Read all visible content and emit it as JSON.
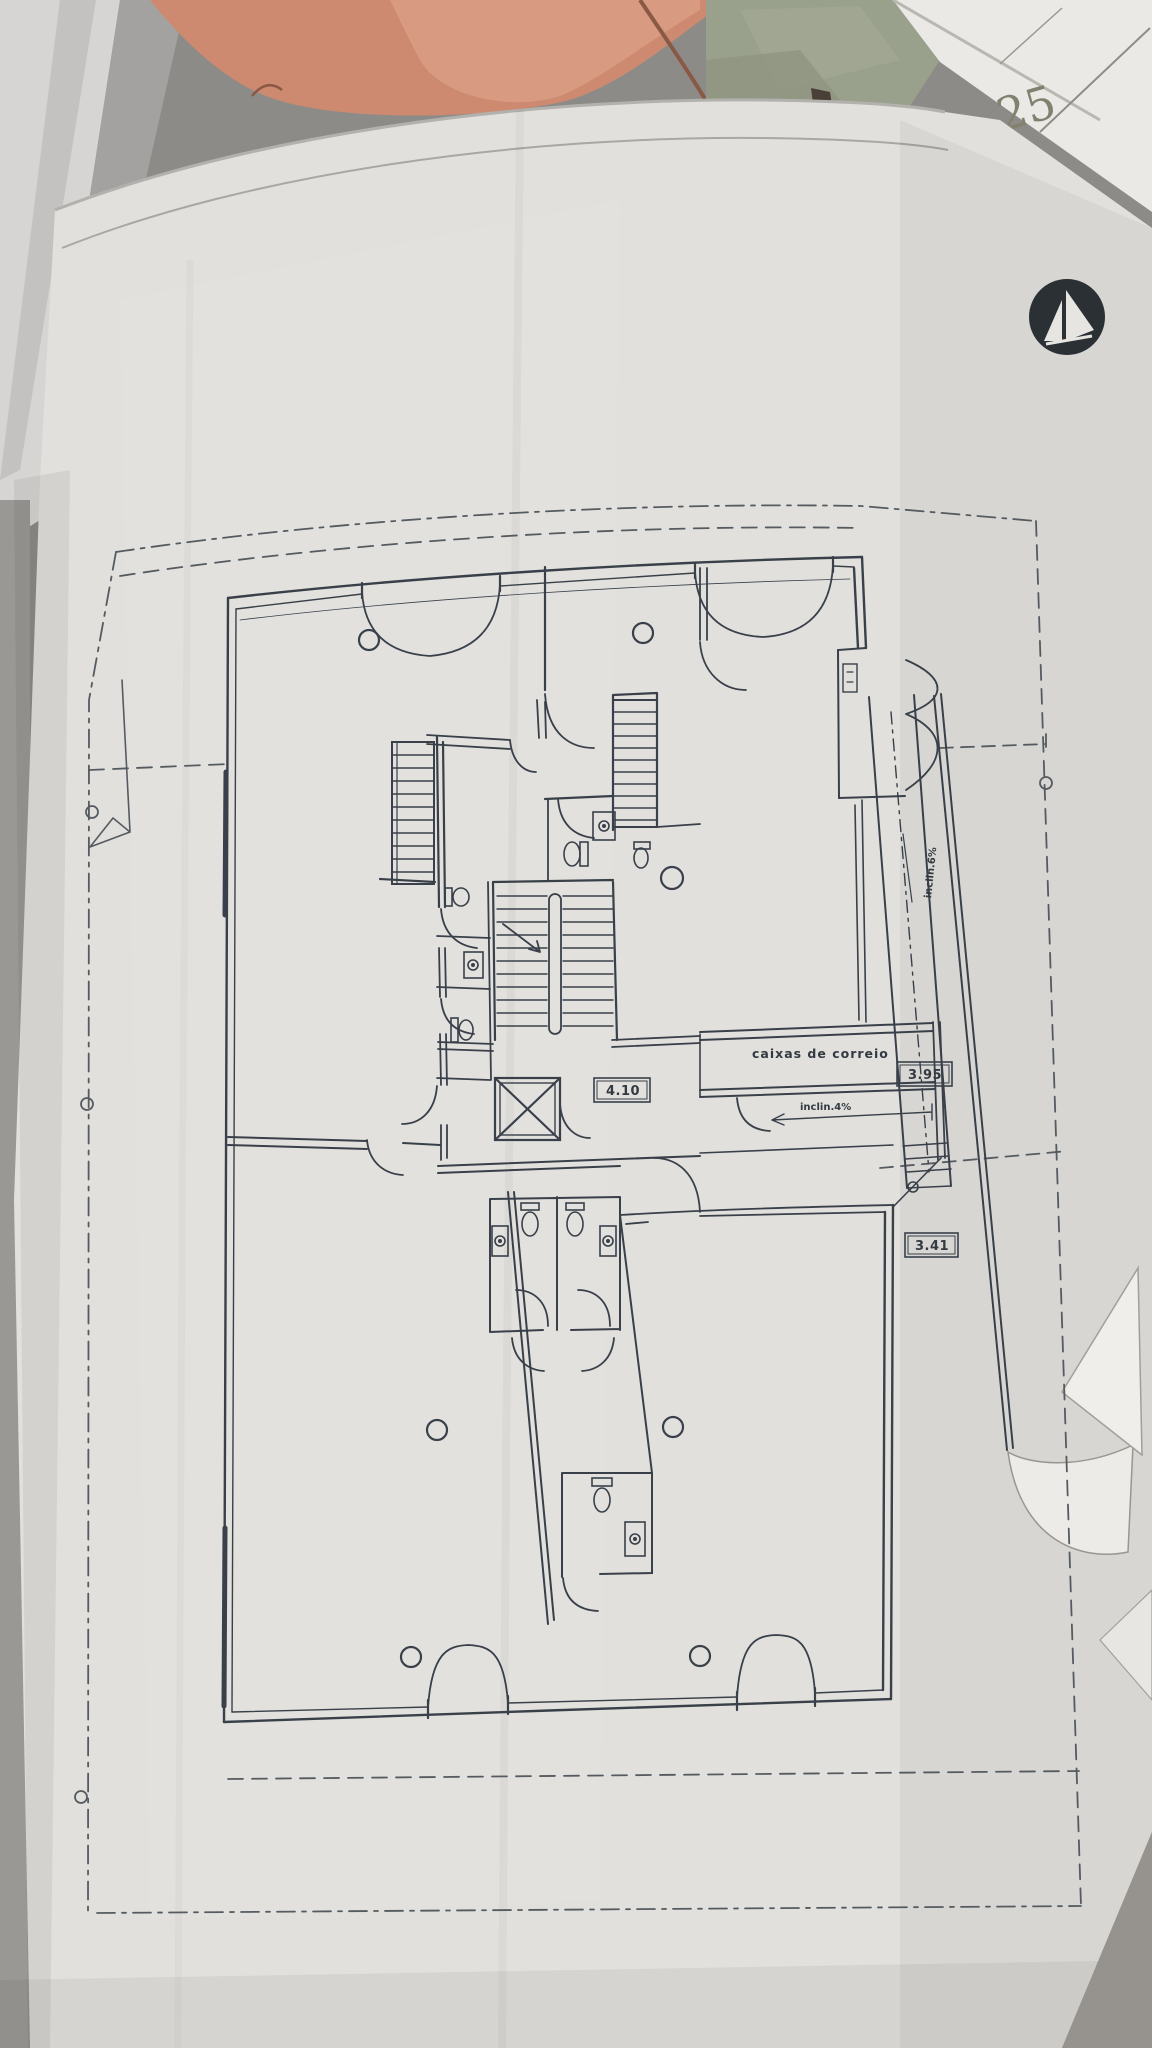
{
  "photo": {
    "subject": "architectural floor plan sheet photographed on a table"
  },
  "plan_labels": {
    "mailboxes": "caixas de correio",
    "dim_core": "4.10",
    "dim_upper_right": "3.95",
    "dim_lower_right": "3.41",
    "ramp_note_horizontal": "inclin.4%",
    "ramp_note_vertical": "inclin.6%"
  },
  "background": {
    "corner_sheet_number": "25"
  },
  "colors": {
    "paper": "#e1e0dc",
    "ink": "#39404a",
    "boundary": "#555b60",
    "salmon_object": "#cd8a70",
    "green_background": "#99a08c",
    "logo": "#2b3034",
    "table": "#8d8b88"
  }
}
